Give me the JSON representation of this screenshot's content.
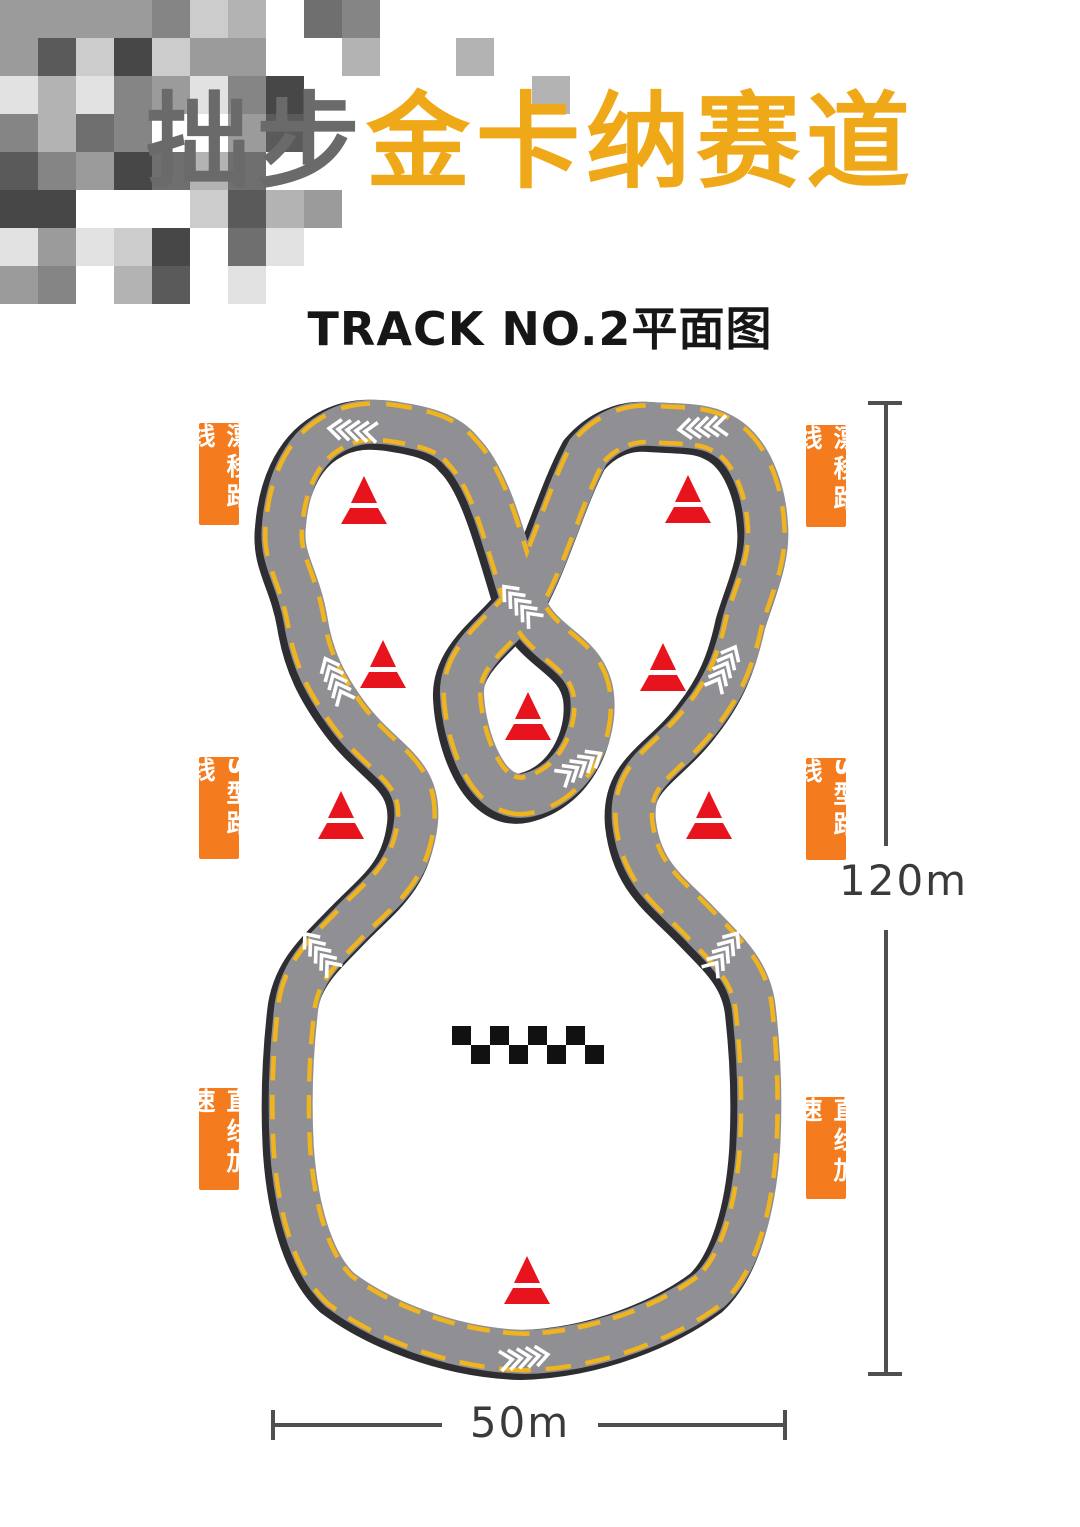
{
  "header": {
    "title_gray": "拙步",
    "title_accent": "金卡纳赛道",
    "subtitle": "TRACK NO.2平面图"
  },
  "route_labels": {
    "drift": "漂移路线",
    "s_curve": "S型路线",
    "straight": "直线加速"
  },
  "dimensions": {
    "height": "120m",
    "width": "50m"
  },
  "colors": {
    "accent_orange": "#f47b1e",
    "title_yellow": "#efa817",
    "title_gray": "#6a6a6a",
    "road_gray": "#909094",
    "road_casing": "#2d2d32",
    "edge_yellow": "#f0b41f",
    "cone_red": "#e8141d",
    "arrow_white": "#ffffff",
    "checker_black": "#111111"
  },
  "track": {
    "cones": [
      {
        "x": 364,
        "y": 476
      },
      {
        "x": 688,
        "y": 475
      },
      {
        "x": 383,
        "y": 640
      },
      {
        "x": 663,
        "y": 643
      },
      {
        "x": 528,
        "y": 692
      },
      {
        "x": 341,
        "y": 791
      },
      {
        "x": 709,
        "y": 791
      },
      {
        "x": 527,
        "y": 1256
      }
    ],
    "arrows": [
      {
        "x": 347,
        "y": 430,
        "rot": 185
      },
      {
        "x": 697,
        "y": 428,
        "rot": 175
      },
      {
        "x": 516,
        "y": 600,
        "rot": 228
      },
      {
        "x": 333,
        "y": 675,
        "rot": 245
      },
      {
        "x": 585,
        "y": 763,
        "rot": -32
      },
      {
        "x": 727,
        "y": 663,
        "rot": -63
      },
      {
        "x": 316,
        "y": 948,
        "rot": 232
      },
      {
        "x": 727,
        "y": 948,
        "rot": -55
      },
      {
        "x": 530,
        "y": 1357,
        "rot": -8
      }
    ],
    "checker": {
      "x": 452,
      "y": 1026,
      "cell": 19,
      "rows": 2,
      "cols": 8
    }
  }
}
